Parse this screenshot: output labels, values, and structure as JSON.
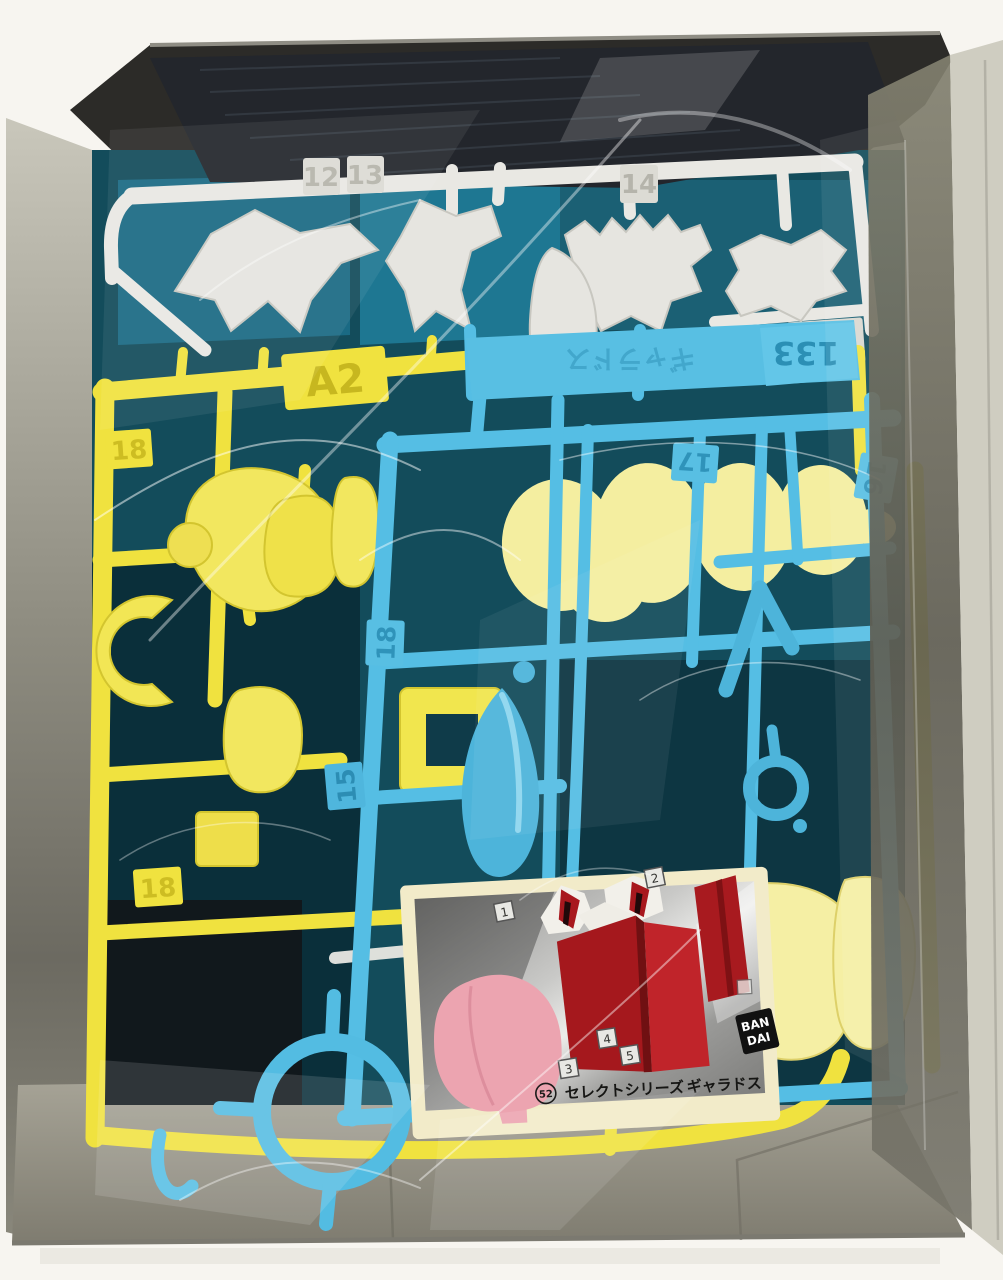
{
  "white_sprue": {
    "labels": {
      "l12": "12",
      "l13": "13",
      "l14": "14"
    },
    "tag": "1A"
  },
  "blue_sprue": {
    "mold_number": "133",
    "mold_name": "ギャラドス",
    "labels": {
      "l15": "15",
      "l16": "16",
      "l17": "17",
      "l18": "18"
    }
  },
  "yellow_sprue": {
    "tag": "A2",
    "labels": {
      "upper": "18",
      "lower": "18"
    }
  },
  "card": {
    "circled_number": "52",
    "series": "セレクトシリーズ",
    "product_name": "ギャラドス",
    "markers": [
      "1",
      "2",
      "3",
      "4",
      "5"
    ],
    "brand_line1": "BAN",
    "brand_line2": "DAI"
  },
  "colors": {
    "background": "#f7f5f0",
    "box_gray": "#9b9889",
    "backdrop_teal": "#134c5b",
    "sprue_white": "#e9e8e3",
    "sprue_yellow": "#f0e23f",
    "sprue_blue": "#55bee4",
    "part_pale_yellow": "#f4eea0",
    "card_red": "#a81a1f",
    "card_pink": "#eca4b0",
    "card_cream": "#f2ebc9",
    "logo_black": "#111111"
  }
}
